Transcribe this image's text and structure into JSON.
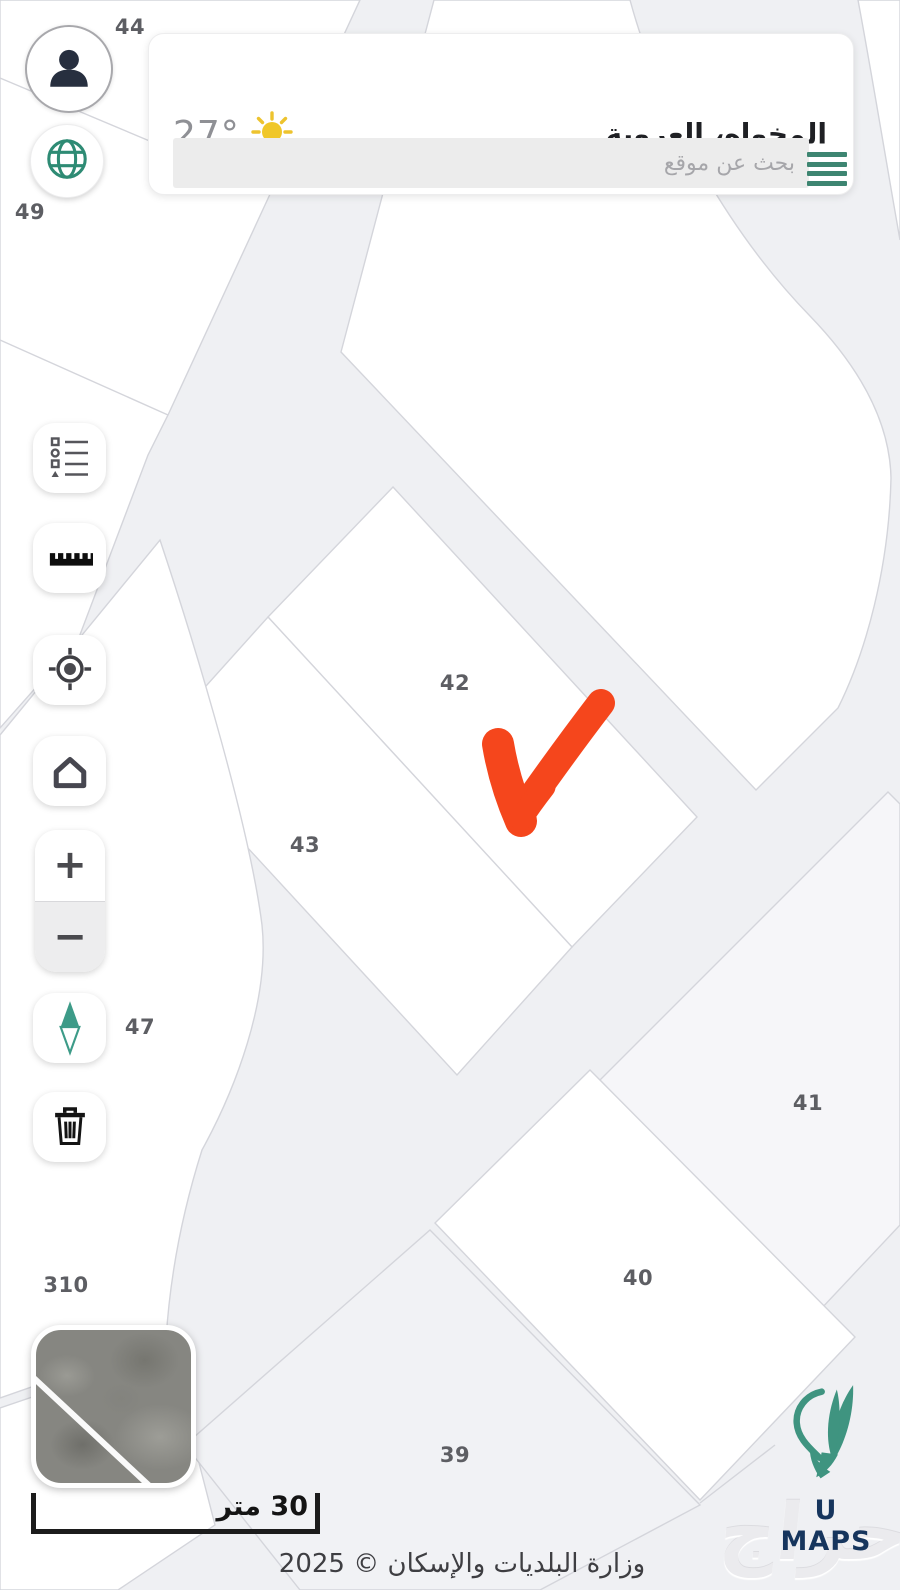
{
  "header": {
    "location_title": "المخواه، العروبة",
    "temperature": "27°",
    "weather_icon": "sun",
    "search_placeholder": "بحث عن موقع",
    "menu_icon": "hamburger-4-lines"
  },
  "account": {
    "avatar_icon": "person",
    "language_icon": "globe"
  },
  "toolbar": {
    "buttons": [
      {
        "name": "legend",
        "icon": "legend-list-icon"
      },
      {
        "name": "measure",
        "icon": "ruler-icon"
      },
      {
        "name": "locate",
        "icon": "crosshair-gps-icon"
      },
      {
        "name": "home",
        "icon": "home-icon"
      },
      {
        "name": "zoom-in",
        "icon": "plus"
      },
      {
        "name": "zoom-out",
        "icon": "minus"
      },
      {
        "name": "compass",
        "icon": "north-diamond-icon"
      },
      {
        "name": "delete",
        "icon": "trash-icon"
      }
    ],
    "zoom_in_glyph": "+",
    "zoom_out_glyph": "−"
  },
  "map": {
    "parcel_labels": [
      {
        "name": "44",
        "x": 130,
        "y": 27
      },
      {
        "name": "49",
        "x": 30,
        "y": 212
      },
      {
        "name": "42",
        "x": 455,
        "y": 683
      },
      {
        "name": "43",
        "x": 305,
        "y": 845
      },
      {
        "name": "47",
        "x": 140,
        "y": 1027
      },
      {
        "name": "41",
        "x": 808,
        "y": 1103
      },
      {
        "name": "40",
        "x": 638,
        "y": 1278
      },
      {
        "name": "39",
        "x": 455,
        "y": 1455
      },
      {
        "name": "310",
        "x": 66,
        "y": 1285
      }
    ],
    "annotation": "red-checkmark-arrow",
    "colors": {
      "road": "#eff0f3",
      "parcel": "#ffffff",
      "parcel_muted": "#f3f3f6",
      "boundary": "#d4d5db",
      "annotation": "#f5461c",
      "teal": "#3d8571",
      "navy": "#16355d"
    }
  },
  "minimap": {
    "type": "satellite-preview"
  },
  "scale_bar": {
    "label": "30 متر"
  },
  "branding": {
    "logo_text": "U MAPS",
    "logo_icon": "teal-leaf-pin"
  },
  "footer": {
    "copyright": "وزارة البلديات والإسكان © 2025",
    "watermark": "حراج"
  }
}
